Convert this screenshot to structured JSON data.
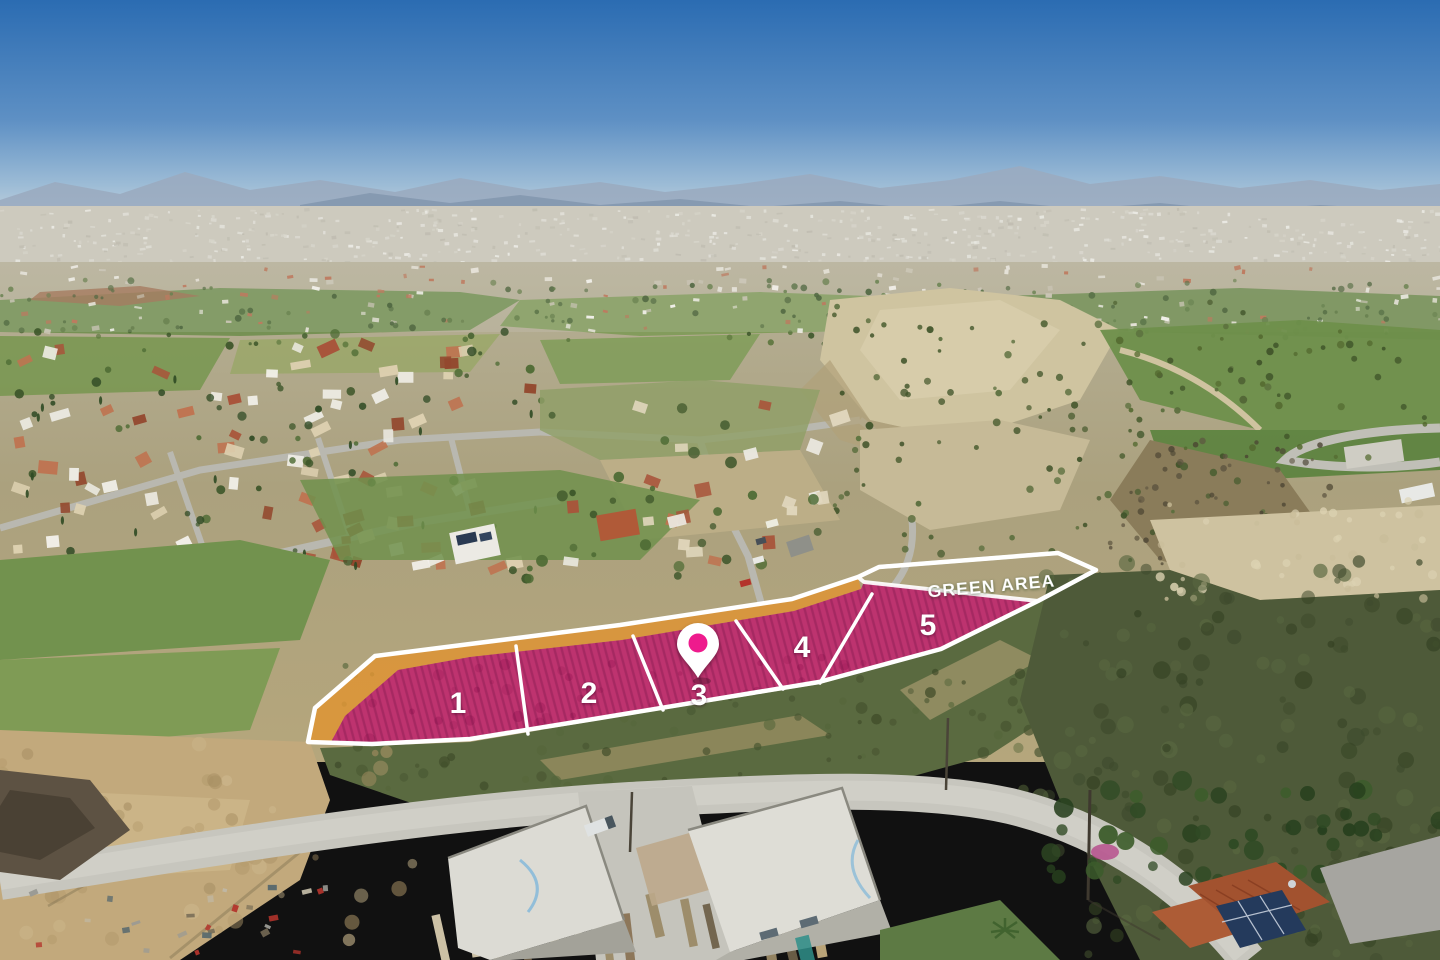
{
  "overlay": {
    "green_area_label": "GREEN AREA",
    "plots": [
      {
        "label": "1"
      },
      {
        "label": "2"
      },
      {
        "label": "3"
      },
      {
        "label": "4"
      },
      {
        "label": "5"
      }
    ],
    "pin_icon": "location-pin",
    "colors": {
      "plot_fill": "#c0176c",
      "road_strip_fill": "#de9434",
      "green_area_fill": "#5fa23c",
      "boundary_white": "#ffffff",
      "label_white": "#ffffff",
      "pin_dot": "#ee1b8d"
    }
  }
}
